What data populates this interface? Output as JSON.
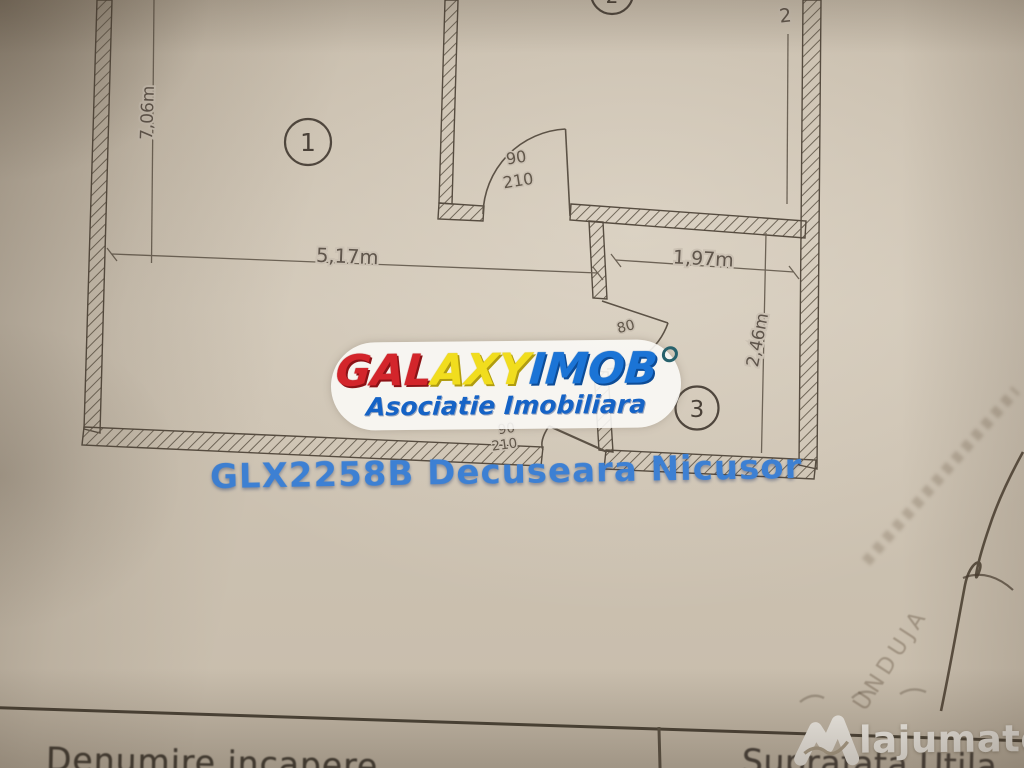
{
  "watermark": {
    "brand": {
      "part_red": "GAL",
      "part_yellow": "AXY",
      "part_blue": "IMOB"
    },
    "subtitle": "Asociatie Imobiliara",
    "listing_code": "GLX2258B Decuseara Nicusor",
    "colors": {
      "red": "#d3252b",
      "yellow": "#f1dd1e",
      "blue": "#1b74d6",
      "subtitle": "#1563c6",
      "listing": "#3d80d3"
    }
  },
  "floor_plan": {
    "room_labels": [
      "1",
      "2",
      "3"
    ],
    "dimensions": {
      "left_height": "7,06m",
      "room1_width": "5,17m",
      "room3_width": "1,97m",
      "room3_height": "2,46m",
      "top_partial": "2"
    },
    "door_labels": {
      "door1_width": "90",
      "door1_height": "210",
      "door2_width": "80",
      "door3_width": "90",
      "door3_height": "210"
    }
  },
  "paper": {
    "stamp_text": "UNDUJA"
  },
  "table": {
    "column1": "Denumire incapere",
    "column2": "Suprafata Utila"
  },
  "site": {
    "logo_text": "lajumate",
    "logo_tld": ".ro",
    "accent": "#44ccb3"
  }
}
